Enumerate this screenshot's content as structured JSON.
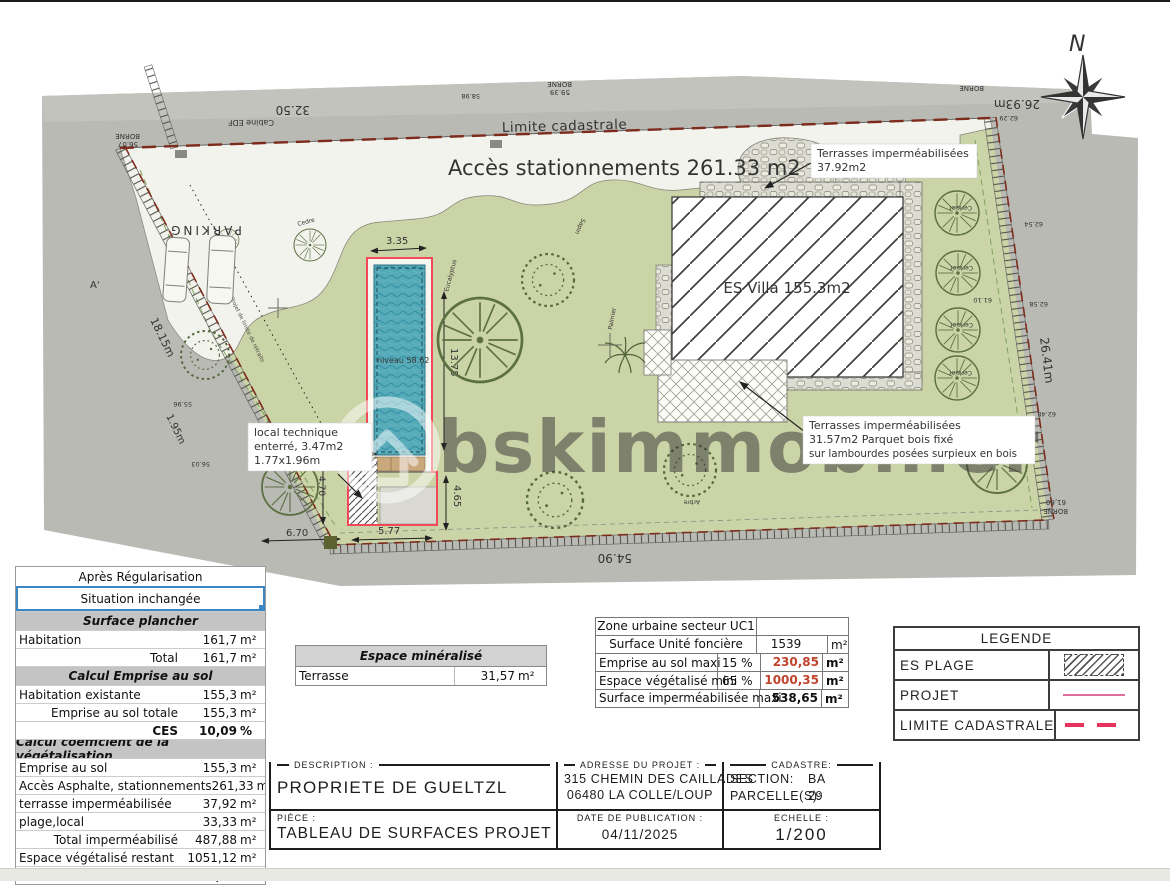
{
  "plan": {
    "north": "N",
    "watermark": "bskimmobilier",
    "acces": "Accès stationnements 261.33 m2",
    "limite": "Limite cadastrale",
    "villa": "ES Villa 155.3m2",
    "parking": "PARKING",
    "niveau": "niveau 58.62",
    "retrait": "Projet de limite de retraits",
    "terrasse_top": {
      "l1": "Terrasses imperméabilisées",
      "l2": "37.92m2"
    },
    "terrasse_bottom": {
      "l1": "Terrasses imperméabilisées",
      "l2": "31.57m2 Parquet bois fixé",
      "l3": "sur lambourdes posées surpieux en bois"
    },
    "local_technique": {
      "l1": "local technique",
      "l2": "enterré, 3.47m2",
      "l3": "1.77x1.96m"
    },
    "dims": {
      "pool_w": "3.35",
      "pool_len": "13.75",
      "plage": "4.65",
      "local_w": "2.4",
      "local_h": "4.70",
      "bottom_1": "6.70",
      "bottom_2": "5.77",
      "street_bottom": "54.90",
      "street_top": "32.50",
      "top_right": "26.93m",
      "left_1": "18.15m",
      "left_2": "1.95m",
      "right": "26.41m",
      "a_prime": "A'"
    },
    "bornes": {
      "b_left": "BORNE",
      "b_left_v": "56.07",
      "b_top": "BORNE",
      "b_top_v": "59.39",
      "b_tr": "BORNE",
      "b_br": "BORNE",
      "b_br_v": "61,60",
      "cabine": "Cabine EDF"
    },
    "elevations": [
      "62.29",
      "62.54",
      "62.58",
      "62.48",
      "61.10",
      "55.96",
      "56.03",
      "58.98"
    ],
    "trees": {
      "cerisier": "Cerisier",
      "sapin": "Sapin",
      "cedre": "Cedre",
      "eucalyptus": "Eucalyptus",
      "palmier": "Palmier",
      "arbre": "Arbre"
    }
  },
  "left_table": {
    "header1": "Après Régularisation",
    "header2": "Situation inchangée",
    "section1": "Surface plancher",
    "section2": "Calcul Emprise au sol",
    "section3": "Calcul coefficient de la végétalisation",
    "rows": [
      {
        "label": "Habitation",
        "value": "161,7",
        "unit": "m²"
      },
      {
        "mid": "Total",
        "value": "161,7",
        "unit": "m²"
      },
      {
        "label": "Habitation existante",
        "value": "155,3",
        "unit": "m²"
      },
      {
        "mid": "Emprise au sol totale",
        "value": "155,3",
        "unit": "m²"
      },
      {
        "mid": "CES",
        "value": "10,09",
        "unit": "%"
      },
      {
        "label": "Emprise au sol",
        "value": "155,3",
        "unit": "m²"
      },
      {
        "label": "Accès Asphalte, stationnements",
        "value": "261,33",
        "unit": "m²"
      },
      {
        "label": "terrasse imperméabilisée",
        "value": "37,92",
        "unit": "m²"
      },
      {
        "label": "plage,local",
        "value": "33,33",
        "unit": "m²"
      },
      {
        "mid": "Total imperméabilisé",
        "value": "487,88",
        "unit": "m²"
      },
      {
        "label": "Espace végétalisé restant",
        "value": "1051,12",
        "unit": "m²"
      },
      {
        "mid": "Soit",
        "value": "68,30",
        "unit": "%"
      }
    ]
  },
  "mineral_table": {
    "header": "Espace minéralisé",
    "row_label": "Terrasse",
    "row_value": "31,57",
    "row_unit": "m²"
  },
  "zone_table": {
    "title": "Zone urbaine secteur UC1",
    "rows": [
      {
        "label": "Surface Unité foncière",
        "value": "1539",
        "unit": "m²"
      },
      {
        "label": "Emprise au sol maxi",
        "pct": "15 %",
        "value": "230,85",
        "unit": "m²"
      },
      {
        "label": "Espace végétalisé mini",
        "pct": "65 %",
        "value": "1000,35",
        "unit": "m²"
      },
      {
        "label": "Surface imperméabilisée maxi",
        "value": "538,65",
        "unit": "m²"
      }
    ]
  },
  "legend": {
    "title": "LEGENDE",
    "rows": [
      {
        "label": "ES PLAGE"
      },
      {
        "label": "PROJET"
      },
      {
        "label": "LIMITE CADASTRALE"
      }
    ]
  },
  "title_block": {
    "description_label": "DESCRIPTION :",
    "description": "PROPRIETE DE GUELTZL",
    "piece_label": "PIÈCE :",
    "piece": "TABLEAU DE SURFACES PROJET",
    "adresse_label": "ADRESSE DU PROJET :",
    "adresse_1": "315 CHEMIN DES CAILLADES",
    "adresse_2": "06480 LA COLLE/LOUP",
    "cadastre_label": "CADASTRE:",
    "section_label": "SECTION:",
    "section": "BA",
    "parcelle_label": "PARCELLE(S):",
    "parcelle": "29",
    "date_label": "DATE DE PUBLICATION :",
    "date": "04/11/2025",
    "echelle_label": "ECHELLE :",
    "echelle": "1/200"
  },
  "colors": {
    "accent_red": "#c0432c",
    "legend_pink": "#e06fa0",
    "legend_red": "#e8315b",
    "blue_border": "#3a87c8",
    "parcel_green": "#cbd4a6"
  }
}
